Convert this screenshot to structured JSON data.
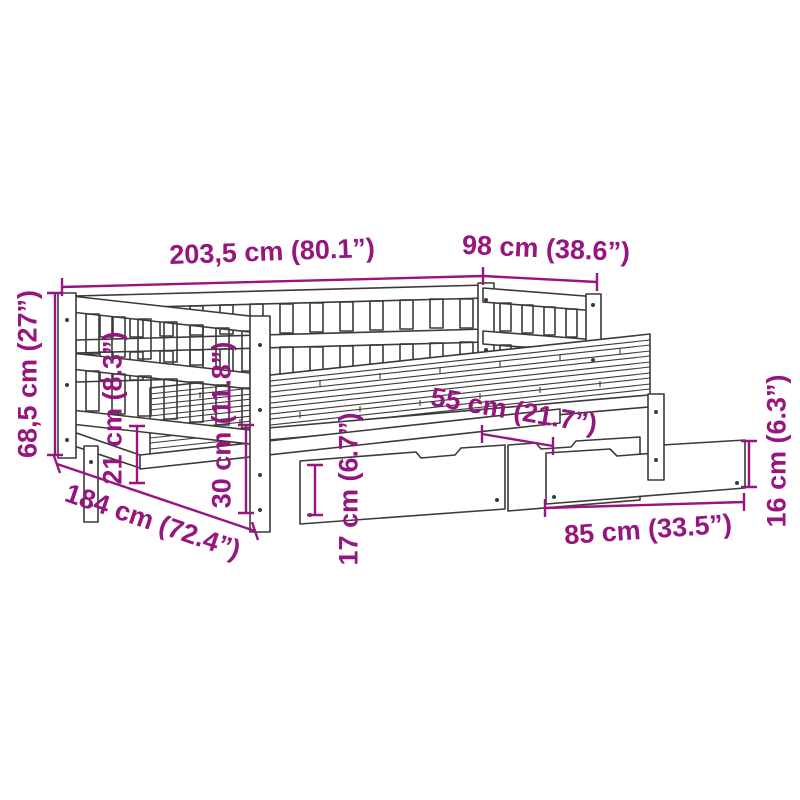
{
  "page": {
    "background_color": "#ffffff",
    "accent_color": "#97157F",
    "line_color": "#3a3a39"
  },
  "diagram": {
    "type": "product-dimension-diagram",
    "subject": "daybed-with-trundle-and-storage-drawers",
    "dimensions": [
      {
        "id": "length-top",
        "label": "203,5 cm (80.1”)"
      },
      {
        "id": "width-top",
        "label": "98 cm (38.6”)"
      },
      {
        "id": "height-left",
        "label": "68,5 cm (27”)"
      },
      {
        "id": "clearance-21",
        "label": "21 cm (8.3”)"
      },
      {
        "id": "height-30",
        "label": "30 cm (11.8”)"
      },
      {
        "id": "drawer-height-17",
        "label": "17 cm (6.7”)"
      },
      {
        "id": "drawer-depth-55",
        "label": "55 cm (21.7”)"
      },
      {
        "id": "drawer-width-85",
        "label": "85 cm (33.5”)"
      },
      {
        "id": "drawer-height-16",
        "label": "16 cm (6.3”)"
      },
      {
        "id": "length-diagonal",
        "label": "184 cm (72.4”)"
      }
    ]
  }
}
